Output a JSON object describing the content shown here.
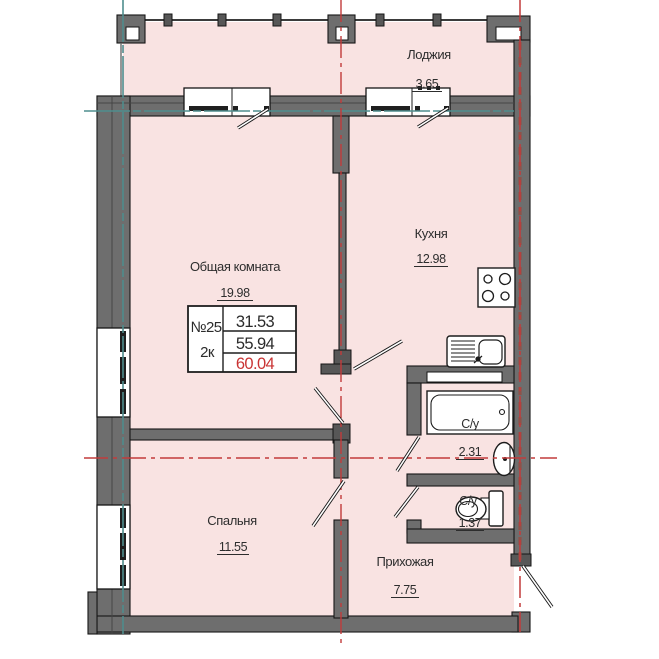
{
  "plan": {
    "unit": {
      "number": "№25",
      "type": "2к",
      "area_living": "31.53",
      "area_apartment": "55.94",
      "area_total": "60.04"
    },
    "rooms": {
      "loggia": {
        "name": "Лоджия",
        "area": "3.65"
      },
      "kitchen": {
        "name": "Кухня",
        "area": "12.98"
      },
      "living": {
        "name": "Общая комната",
        "area": "19.98"
      },
      "bedroom": {
        "name": "Спальня",
        "area": "11.55"
      },
      "hallway": {
        "name": "Прихожая",
        "area": "7.75"
      },
      "bathroom": {
        "name": "С/у",
        "area": "2.31"
      },
      "wc": {
        "name": "С/у",
        "area": "1.37"
      }
    },
    "colors": {
      "room_fill": "#f9e3e2",
      "wall_gray": "#6e6e6e",
      "axis_red": "#c23b3b",
      "axis_teal": "#4f8d8d",
      "total_area_red": "#c93434"
    }
  }
}
